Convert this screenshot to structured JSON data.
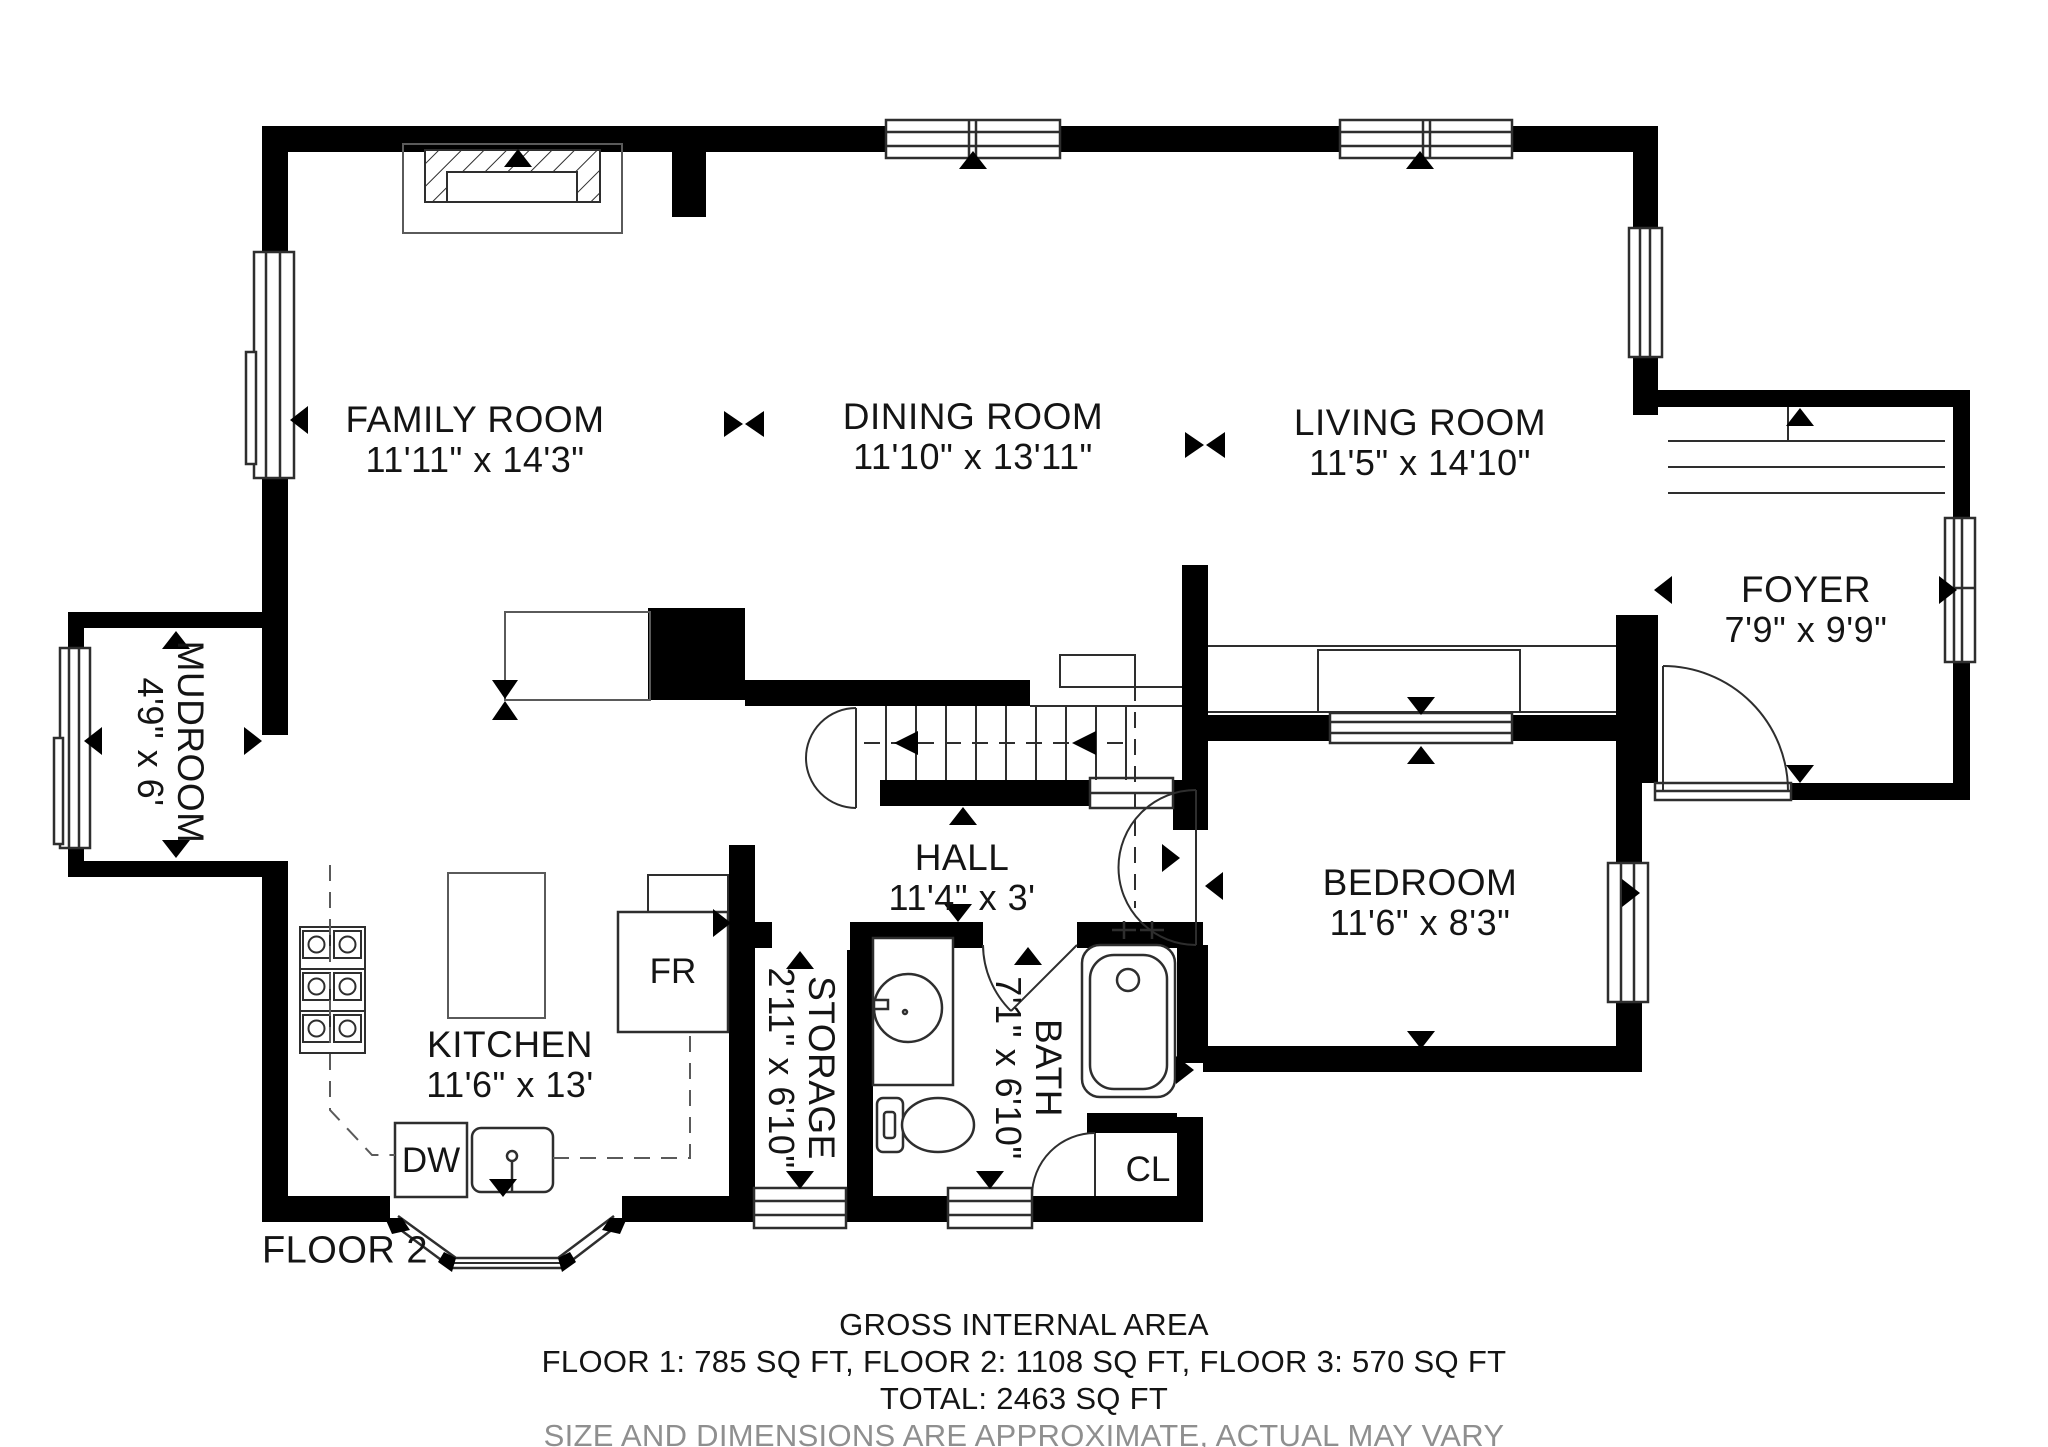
{
  "rooms": {
    "family": {
      "name": "FAMILY ROOM",
      "dims": "11'11\" x 14'3\""
    },
    "dining": {
      "name": "DINING ROOM",
      "dims": "11'10\" x 13'11\""
    },
    "living": {
      "name": "LIVING ROOM",
      "dims": "11'5\" x 14'10\""
    },
    "foyer": {
      "name": "FOYER",
      "dims": "7'9\" x 9'9\""
    },
    "mudroom": {
      "name": "MUDROOM",
      "dims": "4'9\" x 6'"
    },
    "hall": {
      "name": "HALL",
      "dims": "11'4\" x 3'"
    },
    "bedroom": {
      "name": "BEDROOM",
      "dims": "11'6\" x 8'3\""
    },
    "kitchen": {
      "name": "KITCHEN",
      "dims": "11'6\" x 13'"
    },
    "storage": {
      "name": "STORAGE",
      "dims": "2'11\" x 6'10\""
    },
    "bath": {
      "name": "BATH",
      "dims": "7'1\" x 6'10\""
    }
  },
  "fixtures": {
    "fridge": "FR",
    "dishwasher": "DW",
    "closet": "CL"
  },
  "floor_label": "FLOOR 2",
  "footer": {
    "title": "GROSS INTERNAL AREA",
    "floors": "FLOOR 1: 785 SQ FT, FLOOR 2: 1108 SQ FT, FLOOR 3: 570 SQ FT",
    "total": "TOTAL: 2463 SQ FT",
    "disclaimer": "SIZE AND DIMENSIONS ARE APPROXIMATE, ACTUAL MAY VARY"
  },
  "colors": {
    "wall": "#000000",
    "line": "#2e2e2e",
    "text": "#141414",
    "muted": "#8f8f8f"
  }
}
